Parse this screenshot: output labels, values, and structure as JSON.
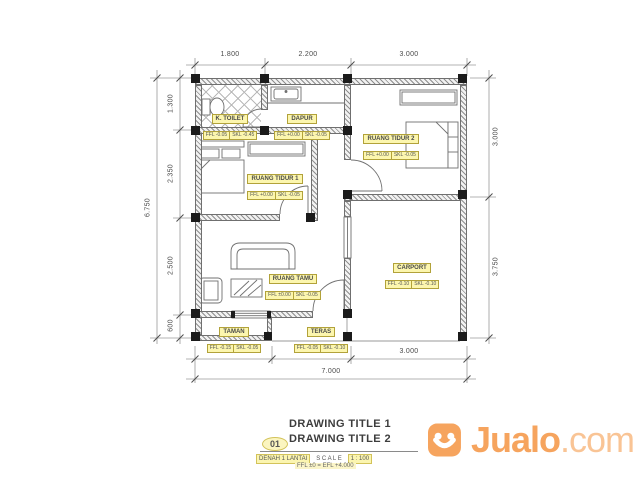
{
  "colors": {
    "highlight_yellow": "#FCF6AE",
    "drawing_gray": "#6f6f6f",
    "jualo_orange": "#F6A45E",
    "jualo_orange_light": "#F9C495"
  },
  "dims": {
    "top": [
      "1.800",
      "2.200",
      "3.000"
    ],
    "left": [
      "1.300",
      "2.350",
      "2.500",
      "600"
    ],
    "left_total": "6.750",
    "right": [
      "3.000",
      "3.750"
    ],
    "bottom": [
      "2.000",
      "2.000",
      "3.000"
    ],
    "bottom_total": "7.000"
  },
  "rooms": {
    "toilet": {
      "name": "K. TOILET",
      "ffl": "FFL -0.05",
      "skl": "SKL -0.45"
    },
    "dapur": {
      "name": "DAPUR",
      "ffl": "FFL +0.00",
      "skl": "SKL -0.05"
    },
    "tidur2": {
      "name": "RUANG TIDUR 2",
      "ffl": "FFL +0.00",
      "skl": "SKL -0.05"
    },
    "tidur1": {
      "name": "RUANG TIDUR 1",
      "ffl": "FFL +0.00",
      "skl": "SKL -0.05"
    },
    "tamu": {
      "name": "RUANG TAMU",
      "ffl": "FFL ±0.00",
      "skl": "SKL -0.05"
    },
    "taman": {
      "name": "TAMAN",
      "ffl": "FFL -0.15",
      "skl": "SKL -0.05"
    },
    "teras": {
      "name": "TERAS",
      "ffl": "FFL -0.05",
      "skl": "SKL -0.10"
    },
    "carport": {
      "name": "CARPORT",
      "ffl": "FFL -0.10",
      "skl": "SKL -0.10"
    }
  },
  "title_block": {
    "sheet_no": "01",
    "title1": "DRAWING TITLE 1",
    "title2": "DRAWING TITLE 2",
    "plan_name": "DENAH 1 LANTAI",
    "scale_label": "S C A L E",
    "scale_value": "1 : 100",
    "level_note": "FFL ±0 = EFL +4.000"
  },
  "watermark": {
    "brand": "Jualo",
    "tld": ".com"
  }
}
